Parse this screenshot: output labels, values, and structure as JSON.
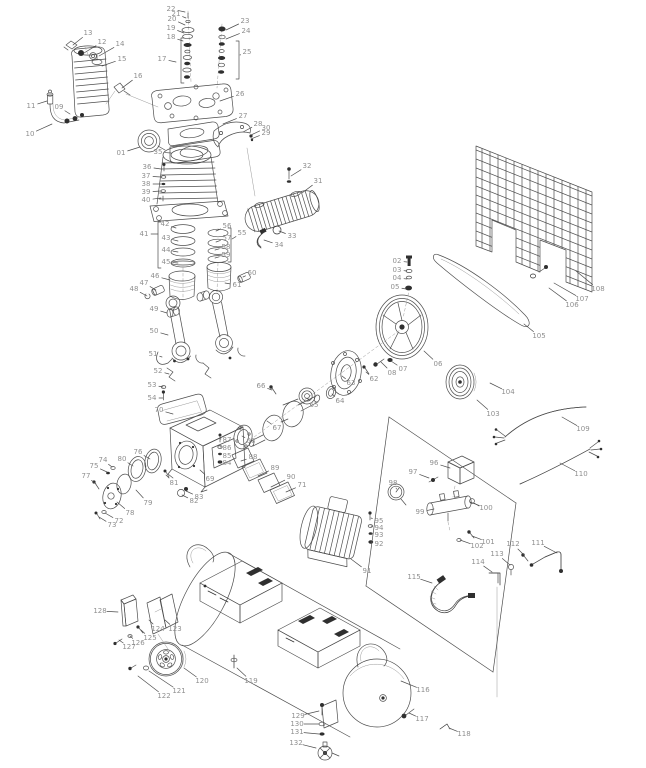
{
  "figure": {
    "type": "exploded-parts-diagram",
    "subject": "belt-drive air compressor spare parts schematic",
    "background": "#ffffff",
    "callout_count": 132
  },
  "style": {
    "line_color": "#4d4d4d",
    "label_color": "#8f8f8f",
    "leader_color": "#a8a8a8",
    "label_font_size": 7
  },
  "parts": [
    {
      "n": "01",
      "x": 121,
      "y": 153,
      "tx": 140,
      "ty": 147
    },
    {
      "n": "02",
      "x": 397,
      "y": 261,
      "tx": 407,
      "ty": 262
    },
    {
      "n": "03",
      "x": 397,
      "y": 270,
      "tx": 407,
      "ty": 271
    },
    {
      "n": "04",
      "x": 397,
      "y": 278,
      "tx": 407,
      "ty": 279
    },
    {
      "n": "05",
      "x": 395,
      "y": 287,
      "tx": 406,
      "ty": 289
    },
    {
      "n": "06",
      "x": 438,
      "y": 364,
      "tx": 424,
      "ty": 351
    },
    {
      "n": "07",
      "x": 403,
      "y": 369,
      "tx": 391,
      "ty": 361
    },
    {
      "n": "08",
      "x": 392,
      "y": 373,
      "tx": 381,
      "ty": 362
    },
    {
      "n": "09",
      "x": 59,
      "y": 107,
      "tx": 70,
      "ty": 114
    },
    {
      "n": "10",
      "x": 30,
      "y": 134,
      "tx": 52,
      "ty": 124
    },
    {
      "n": "11",
      "x": 31,
      "y": 106,
      "tx": 47,
      "ty": 101
    },
    {
      "n": "12",
      "x": 102,
      "y": 42,
      "tx": 84,
      "ty": 53
    },
    {
      "n": "13",
      "x": 88,
      "y": 33,
      "tx": 73,
      "ty": 45
    },
    {
      "n": "14",
      "x": 120,
      "y": 44,
      "tx": 99,
      "ty": 56
    },
    {
      "n": "15",
      "x": 122,
      "y": 59,
      "tx": 102,
      "ty": 66
    },
    {
      "n": "16",
      "x": 138,
      "y": 76,
      "tx": 122,
      "ty": 88
    },
    {
      "n": "17",
      "x": 162,
      "y": 59,
      "tx": 176,
      "ty": 62
    },
    {
      "n": "18",
      "x": 171,
      "y": 37,
      "tx": 183,
      "ty": 41
    },
    {
      "n": "19",
      "x": 171,
      "y": 28,
      "tx": 184,
      "ty": 33
    },
    {
      "n": "20",
      "x": 172,
      "y": 19,
      "tx": 185,
      "ty": 25
    },
    {
      "n": "21",
      "x": 176,
      "y": 14,
      "tx": 186,
      "ty": 18
    },
    {
      "n": "22",
      "x": 171,
      "y": 9,
      "tx": 185,
      "ty": 12
    },
    {
      "n": "23",
      "x": 245,
      "y": 21,
      "tx": 226,
      "ty": 30
    },
    {
      "n": "24",
      "x": 246,
      "y": 31,
      "tx": 226,
      "ty": 39
    },
    {
      "n": "25",
      "x": 247,
      "y": 52,
      "tx": 240,
      "ty": 55
    },
    {
      "n": "26",
      "x": 240,
      "y": 94,
      "tx": 220,
      "ty": 101
    },
    {
      "n": "27",
      "x": 243,
      "y": 116,
      "tx": 223,
      "ty": 124
    },
    {
      "n": "28",
      "x": 258,
      "y": 124,
      "tx": 243,
      "ty": 132
    },
    {
      "n": "29",
      "x": 266,
      "y": 133,
      "tx": 251,
      "ty": 139
    },
    {
      "n": "30",
      "x": 266,
      "y": 128,
      "tx": 251,
      "ty": 135
    },
    {
      "n": "31",
      "x": 318,
      "y": 181,
      "tx": 302,
      "ty": 193
    },
    {
      "n": "32",
      "x": 307,
      "y": 166,
      "tx": 291,
      "ty": 176
    },
    {
      "n": "33",
      "x": 292,
      "y": 236,
      "tx": 279,
      "ty": 231
    },
    {
      "n": "34",
      "x": 279,
      "y": 245,
      "tx": 264,
      "ty": 240
    },
    {
      "n": "35",
      "x": 158,
      "y": 152,
      "tx": 171,
      "ty": 153
    },
    {
      "n": "36",
      "x": 147,
      "y": 167,
      "tx": 161,
      "ty": 169
    },
    {
      "n": "37",
      "x": 146,
      "y": 176,
      "tx": 161,
      "ty": 177
    },
    {
      "n": "38",
      "x": 146,
      "y": 184,
      "tx": 161,
      "ty": 184
    },
    {
      "n": "39",
      "x": 146,
      "y": 192,
      "tx": 161,
      "ty": 191
    },
    {
      "n": "40",
      "x": 146,
      "y": 200,
      "tx": 161,
      "ty": 198
    },
    {
      "n": "41",
      "x": 144,
      "y": 234,
      "tx": 158,
      "ty": 234
    },
    {
      "n": "42",
      "x": 165,
      "y": 224,
      "tx": 176,
      "ty": 228
    },
    {
      "n": "43",
      "x": 166,
      "y": 238,
      "tx": 178,
      "ty": 241
    },
    {
      "n": "44",
      "x": 166,
      "y": 250,
      "tx": 178,
      "ty": 252
    },
    {
      "n": "45",
      "x": 166,
      "y": 262,
      "tx": 178,
      "ty": 263
    },
    {
      "n": "46",
      "x": 155,
      "y": 276,
      "tx": 170,
      "ty": 280
    },
    {
      "n": "47",
      "x": 144,
      "y": 283,
      "tx": 156,
      "ty": 290
    },
    {
      "n": "48",
      "x": 134,
      "y": 289,
      "tx": 147,
      "ty": 296
    },
    {
      "n": "49",
      "x": 154,
      "y": 309,
      "tx": 167,
      "ty": 313
    },
    {
      "n": "50",
      "x": 154,
      "y": 331,
      "tx": 168,
      "ty": 335
    },
    {
      "n": "51",
      "x": 153,
      "y": 354,
      "tx": 162,
      "ty": 357
    },
    {
      "n": "52",
      "x": 158,
      "y": 371,
      "tx": 169,
      "ty": 374
    },
    {
      "n": "53",
      "x": 152,
      "y": 385,
      "tx": 163,
      "ty": 387
    },
    {
      "n": "54",
      "x": 152,
      "y": 398,
      "tx": 163,
      "ty": 398
    },
    {
      "n": "55",
      "x": 242,
      "y": 233,
      "tx": 232,
      "ty": 239
    },
    {
      "n": "56",
      "x": 227,
      "y": 226,
      "tx": 216,
      "ty": 231
    },
    {
      "n": "57",
      "x": 227,
      "y": 238,
      "tx": 216,
      "ty": 242
    },
    {
      "n": "58",
      "x": 226,
      "y": 247,
      "tx": 215,
      "ty": 250
    },
    {
      "n": "59",
      "x": 226,
      "y": 255,
      "tx": 215,
      "ty": 258
    },
    {
      "n": "60",
      "x": 252,
      "y": 273,
      "tx": 243,
      "ty": 277
    },
    {
      "n": "61",
      "x": 237,
      "y": 285,
      "tx": 225,
      "ty": 283
    },
    {
      "n": "62",
      "x": 374,
      "y": 379,
      "tx": 366,
      "ty": 372
    },
    {
      "n": "63",
      "x": 351,
      "y": 383,
      "tx": 342,
      "ty": 376
    },
    {
      "n": "64",
      "x": 340,
      "y": 401,
      "tx": 332,
      "ty": 394
    },
    {
      "n": "65",
      "x": 314,
      "y": 405,
      "tx": 307,
      "ty": 398
    },
    {
      "n": "66",
      "x": 261,
      "y": 386,
      "tx": 272,
      "ty": 390
    },
    {
      "n": "67",
      "x": 277,
      "y": 428,
      "tx": 267,
      "ty": 421
    },
    {
      "n": "68",
      "x": 251,
      "y": 441,
      "tx": 242,
      "ty": 436
    },
    {
      "n": "69",
      "x": 210,
      "y": 479,
      "tx": 200,
      "ty": 470
    },
    {
      "n": "70",
      "x": 159,
      "y": 410,
      "tx": 173,
      "ty": 414
    },
    {
      "n": "71",
      "x": 302,
      "y": 485,
      "tx": 286,
      "ty": 492
    },
    {
      "n": "72",
      "x": 119,
      "y": 521,
      "tx": 105,
      "ty": 513
    },
    {
      "n": "73",
      "x": 112,
      "y": 525,
      "tx": 99,
      "ty": 517
    },
    {
      "n": "74",
      "x": 103,
      "y": 460,
      "tx": 112,
      "ty": 467
    },
    {
      "n": "75",
      "x": 94,
      "y": 466,
      "tx": 107,
      "ty": 472
    },
    {
      "n": "76",
      "x": 138,
      "y": 452,
      "tx": 150,
      "ty": 459
    },
    {
      "n": "77",
      "x": 86,
      "y": 476,
      "tx": 96,
      "ty": 484
    },
    {
      "n": "78",
      "x": 130,
      "y": 513,
      "tx": 117,
      "ty": 502
    },
    {
      "n": "79",
      "x": 148,
      "y": 503,
      "tx": 136,
      "ty": 490
    },
    {
      "n": "80",
      "x": 122,
      "y": 459,
      "tx": 133,
      "ty": 466
    },
    {
      "n": "81",
      "x": 174,
      "y": 483,
      "tx": 166,
      "ty": 475
    },
    {
      "n": "82",
      "x": 194,
      "y": 501,
      "tx": 182,
      "ty": 495
    },
    {
      "n": "83",
      "x": 199,
      "y": 497,
      "tx": 186,
      "ty": 491
    },
    {
      "n": "84",
      "x": 227,
      "y": 463,
      "tx": 221,
      "ty": 462
    },
    {
      "n": "85",
      "x": 227,
      "y": 456,
      "tx": 221,
      "ty": 454
    },
    {
      "n": "86",
      "x": 227,
      "y": 448,
      "tx": 221,
      "ty": 447
    },
    {
      "n": "87",
      "x": 227,
      "y": 440,
      "tx": 221,
      "ty": 439
    },
    {
      "n": "88",
      "x": 253,
      "y": 457,
      "tx": 241,
      "ty": 461
    },
    {
      "n": "89",
      "x": 275,
      "y": 468,
      "tx": 258,
      "ty": 476
    },
    {
      "n": "90",
      "x": 291,
      "y": 477,
      "tx": 271,
      "ty": 487
    },
    {
      "n": "91",
      "x": 367,
      "y": 571,
      "tx": 351,
      "ty": 559
    },
    {
      "n": "92",
      "x": 379,
      "y": 544,
      "tx": 371,
      "ty": 542
    },
    {
      "n": "93",
      "x": 379,
      "y": 535,
      "tx": 371,
      "ty": 533
    },
    {
      "n": "94",
      "x": 379,
      "y": 528,
      "tx": 371,
      "ty": 526
    },
    {
      "n": "95",
      "x": 379,
      "y": 521,
      "tx": 371,
      "ty": 518
    },
    {
      "n": "96",
      "x": 434,
      "y": 463,
      "tx": 450,
      "ty": 468
    },
    {
      "n": "97",
      "x": 413,
      "y": 472,
      "tx": 429,
      "ty": 478
    },
    {
      "n": "98",
      "x": 393,
      "y": 483,
      "tx": 396,
      "ty": 488
    },
    {
      "n": "99",
      "x": 420,
      "y": 512,
      "tx": 434,
      "ty": 509
    },
    {
      "n": "100",
      "x": 486,
      "y": 508,
      "tx": 470,
      "ty": 502
    },
    {
      "n": "101",
      "x": 488,
      "y": 542,
      "tx": 472,
      "ty": 536
    },
    {
      "n": "102",
      "x": 477,
      "y": 546,
      "tx": 460,
      "ty": 540
    },
    {
      "n": "103",
      "x": 493,
      "y": 414,
      "tx": 477,
      "ty": 400
    },
    {
      "n": "104",
      "x": 508,
      "y": 392,
      "tx": 490,
      "ty": 383
    },
    {
      "n": "105",
      "x": 539,
      "y": 336,
      "tx": 524,
      "ty": 324
    },
    {
      "n": "106",
      "x": 572,
      "y": 305,
      "tx": 549,
      "ty": 288
    },
    {
      "n": "107",
      "x": 582,
      "y": 299,
      "tx": 554,
      "ty": 283
    },
    {
      "n": "108",
      "x": 598,
      "y": 289,
      "tx": 576,
      "ty": 271
    },
    {
      "n": "109",
      "x": 583,
      "y": 429,
      "tx": 562,
      "ty": 417
    },
    {
      "n": "110",
      "x": 581,
      "y": 474,
      "tx": 560,
      "ty": 463
    },
    {
      "n": "111",
      "x": 538,
      "y": 543,
      "tx": 557,
      "ty": 553
    },
    {
      "n": "112",
      "x": 513,
      "y": 544,
      "tx": 524,
      "ty": 555
    },
    {
      "n": "113",
      "x": 497,
      "y": 554,
      "tx": 510,
      "ty": 565
    },
    {
      "n": "114",
      "x": 478,
      "y": 562,
      "tx": 492,
      "ty": 572
    },
    {
      "n": "115",
      "x": 414,
      "y": 577,
      "tx": 432,
      "ty": 583
    },
    {
      "n": "116",
      "x": 423,
      "y": 690,
      "tx": 401,
      "ty": 681
    },
    {
      "n": "117",
      "x": 422,
      "y": 719,
      "tx": 409,
      "ty": 713
    },
    {
      "n": "118",
      "x": 464,
      "y": 734,
      "tx": 449,
      "ty": 728
    },
    {
      "n": "119",
      "x": 251,
      "y": 681,
      "tx": 237,
      "ty": 668
    },
    {
      "n": "120",
      "x": 202,
      "y": 681,
      "tx": 184,
      "ty": 668
    },
    {
      "n": "121",
      "x": 179,
      "y": 691,
      "tx": 149,
      "ty": 671
    },
    {
      "n": "122",
      "x": 164,
      "y": 696,
      "tx": 138,
      "ty": 676
    },
    {
      "n": "123",
      "x": 175,
      "y": 629,
      "tx": 165,
      "ty": 620
    },
    {
      "n": "124",
      "x": 158,
      "y": 629,
      "tx": 149,
      "ty": 620
    },
    {
      "n": "125",
      "x": 150,
      "y": 638,
      "tx": 141,
      "ty": 630
    },
    {
      "n": "126",
      "x": 138,
      "y": 643,
      "tx": 130,
      "ty": 636
    },
    {
      "n": "127",
      "x": 129,
      "y": 647,
      "tx": 119,
      "ty": 640
    },
    {
      "n": "128",
      "x": 100,
      "y": 611,
      "tx": 118,
      "ty": 612
    },
    {
      "n": "129",
      "x": 298,
      "y": 716,
      "tx": 319,
      "ty": 711
    },
    {
      "n": "130",
      "x": 297,
      "y": 724,
      "tx": 319,
      "ty": 724
    },
    {
      "n": "131",
      "x": 297,
      "y": 732,
      "tx": 319,
      "ty": 734
    },
    {
      "n": "132",
      "x": 296,
      "y": 743,
      "tx": 316,
      "ty": 748
    }
  ]
}
